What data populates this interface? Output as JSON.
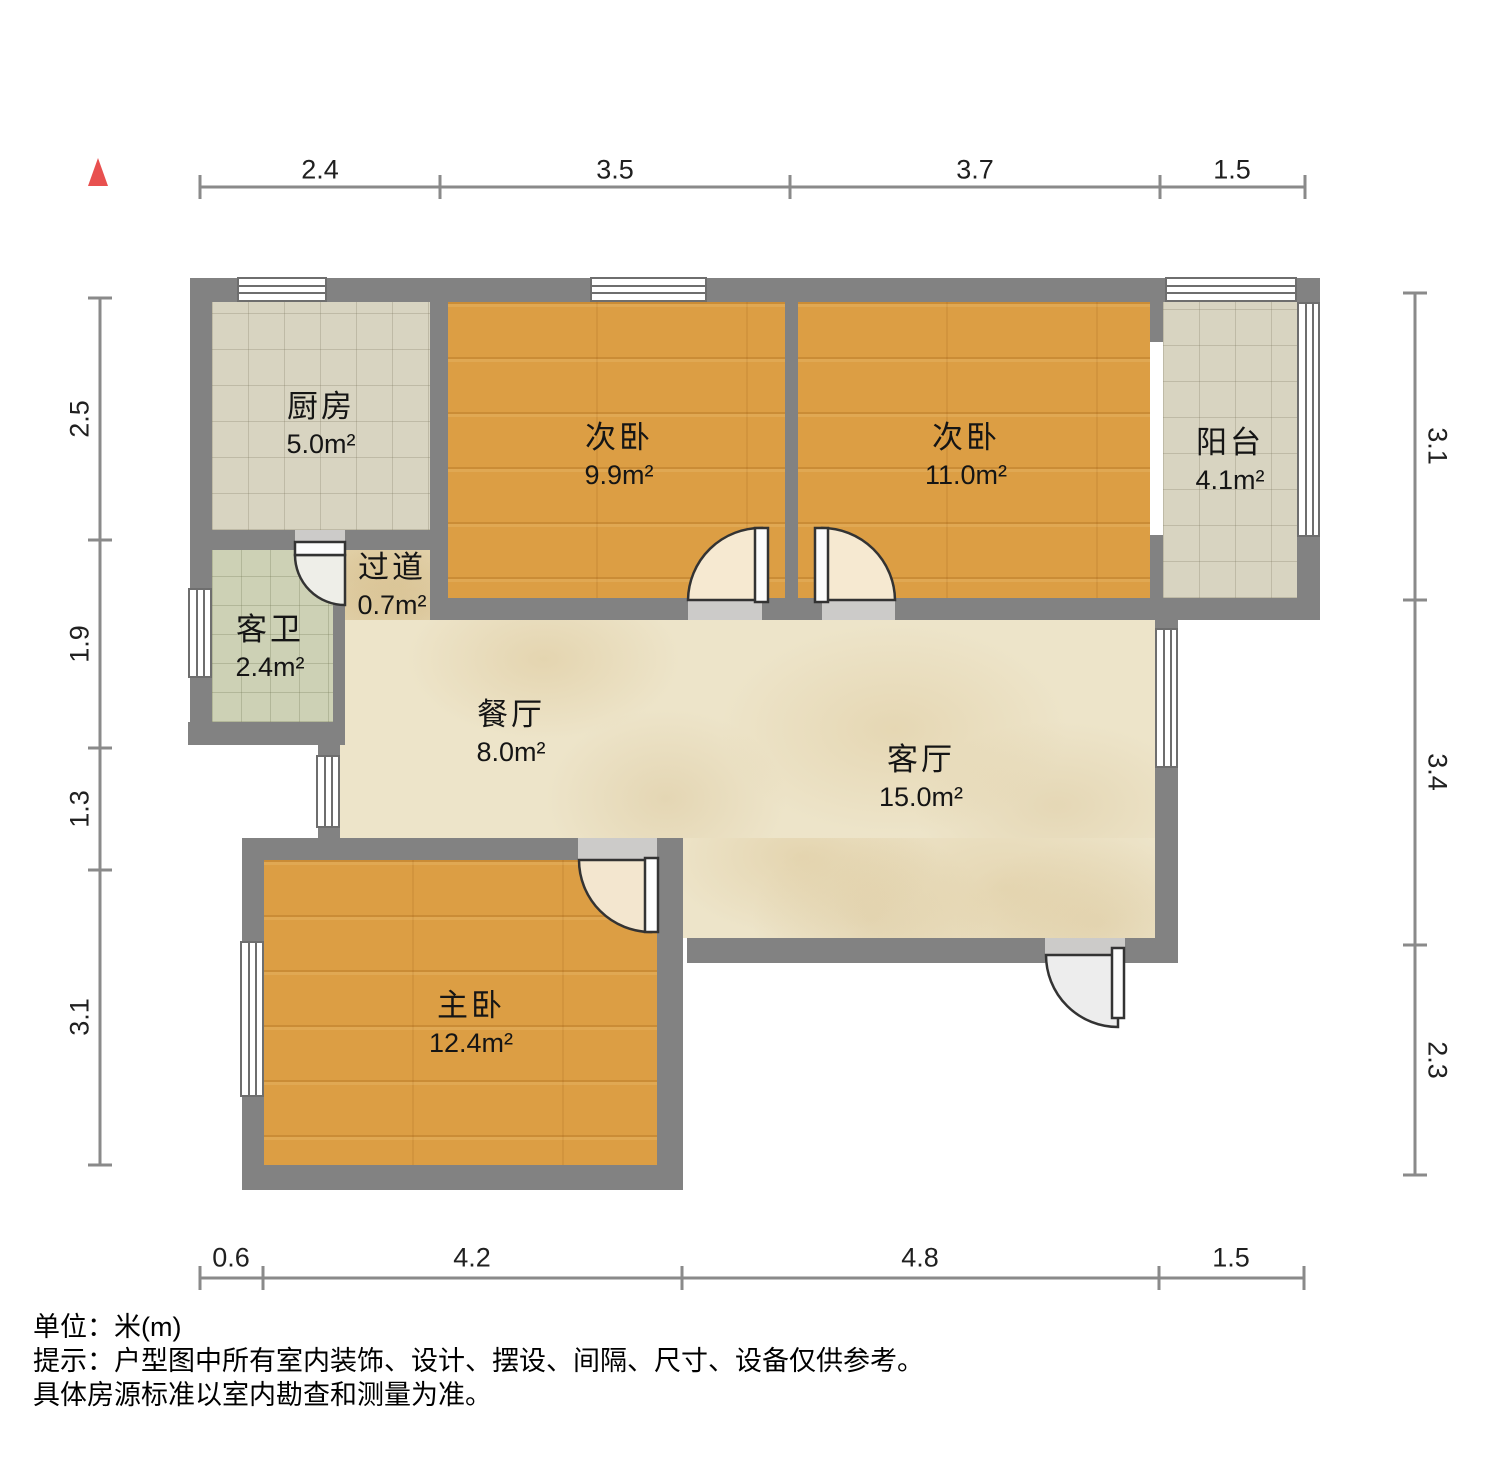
{
  "rooms": {
    "kitchen": {
      "label": "厨房",
      "area": "5.0m²"
    },
    "bedroom_a": {
      "label": "次卧",
      "area": "9.9m²"
    },
    "bedroom_b": {
      "label": "次卧",
      "area": "11.0m²"
    },
    "balcony": {
      "label": "阳台",
      "area": "4.1m²"
    },
    "hallway": {
      "label": "过道",
      "area": "0.7m²"
    },
    "bathroom": {
      "label": "客卫",
      "area": "2.4m²"
    },
    "dining": {
      "label": "餐厅",
      "area": "8.0m²"
    },
    "living": {
      "label": "客厅",
      "area": "15.0m²"
    },
    "master": {
      "label": "主卧",
      "area": "12.4m²"
    }
  },
  "dimensions": {
    "top": [
      "2.4",
      "3.5",
      "3.7",
      "1.5"
    ],
    "bottom": [
      "0.6",
      "4.2",
      "4.8",
      "1.5"
    ],
    "left": [
      "2.5",
      "1.9",
      "1.3",
      "3.1"
    ],
    "right": [
      "3.1",
      "3.4",
      "2.3"
    ]
  },
  "notes": {
    "unit": "单位：米(m)",
    "tip1": "提示：户型图中所有室内装饰、设计、摆设、间隔、尺寸、设备仅供参考。",
    "tip2": "具体房源标准以室内勘查和测量为准。"
  },
  "colors": {
    "wall": "#828282",
    "wood_floor": "#dc9e44",
    "tile_floor": "#d8d4c1",
    "bath_tile_floor": "#cdd1b5",
    "marble_floor": "#ede4c9",
    "north_arrow": "#e8504f"
  }
}
